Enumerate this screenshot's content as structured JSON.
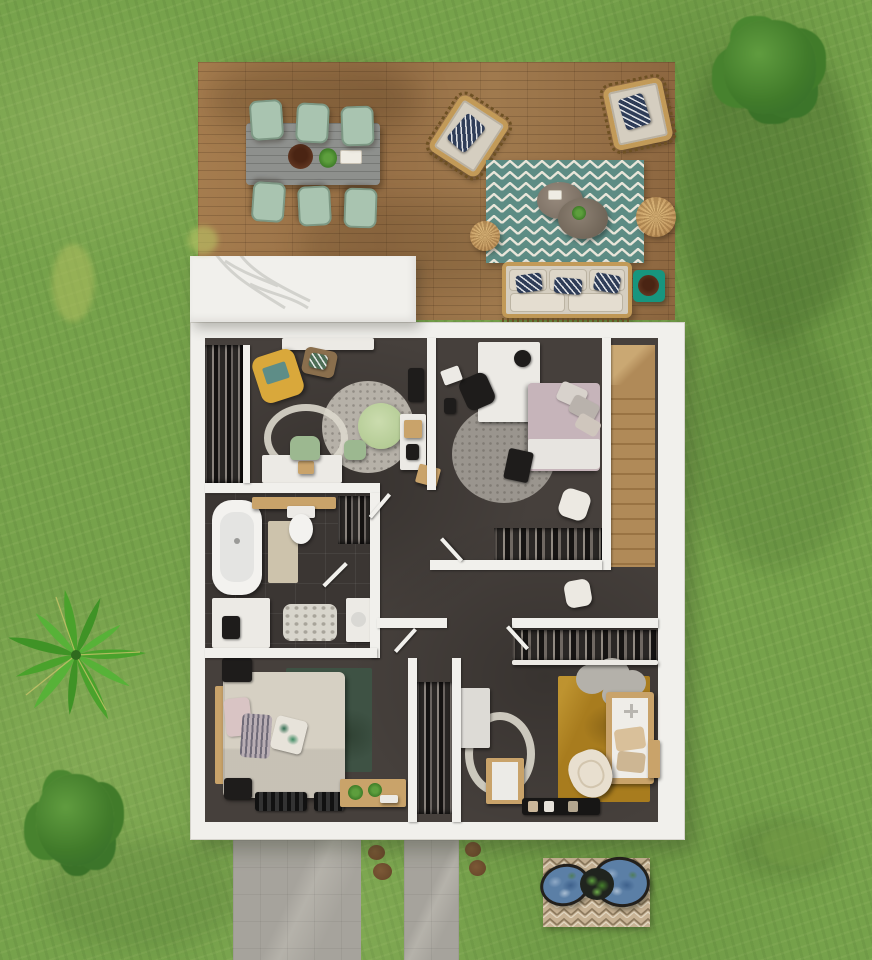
{
  "scene": {
    "type": "3d-top-down-floor-plan-render",
    "floor": "upper floor with outdoor deck, lawn and walkways",
    "visible_text": "none"
  },
  "palette": {
    "grass_base": "#76a24b",
    "deck_wood": "#a07a4e",
    "house_wall": "#f1f0ec",
    "floor_dark": "#46403c",
    "floor_tile": "#3b3633",
    "stair_wood": "#b08a58",
    "stair_wood_dark": "#997343",
    "table_gray": "#8e908d",
    "chair_mint": "#a9c4b0",
    "rug_teal": "#5d8c84",
    "rug_cream": "#e9e6da",
    "sofa_frame": "#c29a58",
    "cushion_beige": "#d5cec0",
    "navy": "#2f3d58",
    "jute": "#c49a62",
    "teal_accent": "#17957e",
    "bowl_brown": "#5f3520",
    "office_rug": "#b6b1a8",
    "ring_rug": "#dcd8cc",
    "green_table": "#b5cc96",
    "green_seat": "#9cb890",
    "yellow_chair": "#d9a83b",
    "wood_light": "#c9a36a",
    "bed_pink": "#c6b4ba",
    "sheet_white": "#e7e4e0",
    "dark_obj": "#1e1c1b",
    "rug_gray": "#9a958e",
    "bed_beige": "#d6d0c3",
    "rug_green": "#3e5244",
    "rug_mustard": "#a87c1e",
    "rug_cloud": "#b4b1aa",
    "cream": "#e8dfcf",
    "path_gray": "#a6a39c",
    "mat_tan": "#c7b294",
    "stone_brown": "#6b4a2c",
    "egg_blue": "#5b7fa6",
    "bush_green": "#417b2a",
    "closet_dark": "#2a2725"
  },
  "objects": {
    "deck": [
      "dining-table",
      "six-mint-chairs",
      "wicker-armchair-x2",
      "chevron-rug",
      "coffee-tables-x2",
      "jute-pouf-x2",
      "outdoor-sofa",
      "teal-side-table"
    ],
    "office_room": [
      "yellow-armchair",
      "floor-pouf",
      "round-speckled-rug",
      "green-round-table",
      "green-stool",
      "ring-rug",
      "white-desk",
      "desk-chair",
      "wall-shelf",
      "wardrobe"
    ],
    "bedroom_top_right": [
      "white-desk",
      "black-chair",
      "laptop",
      "double-bed-pink",
      "round-gray-rug",
      "black-mat",
      "white-pouf",
      "open-wardrobe"
    ],
    "stairwell": [
      "wooden-staircase"
    ],
    "bathroom": [
      "bathtub",
      "toilet",
      "wood-shelf",
      "bath-mat",
      "vanity-cabinet",
      "stone-rug",
      "sink",
      "wardrobe",
      "door"
    ],
    "bedroom_bottom_left": [
      "double-bed-beige",
      "green-mottled-rug",
      "nightstands",
      "bench-racks",
      "wood-desk-with-plants"
    ],
    "nursery": [
      "mustard-rug",
      "cloud-rug",
      "crib",
      "cream-rocking-chair",
      "white-cabinet",
      "dresser",
      "ring-rug",
      "doormat-with-shoes"
    ],
    "garden": [
      "palm-plant",
      "tree",
      "bush",
      "concrete-path-x2",
      "stepping-stones",
      "patio-mat",
      "egg-chair-x2",
      "planter"
    ]
  }
}
